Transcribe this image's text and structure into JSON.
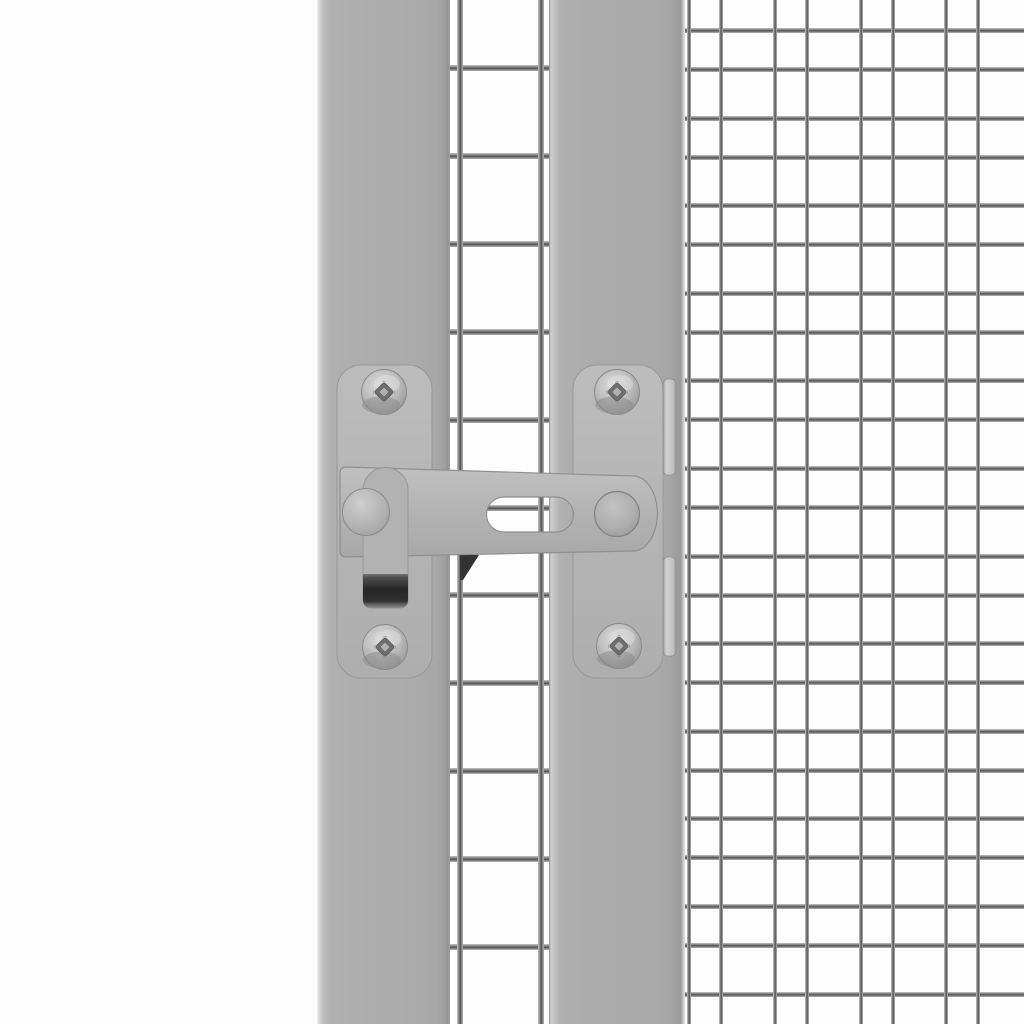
{
  "meta": {
    "description": "Close-up product photo of a grey metal gate latch mounted across two grey square posts of a wire-mesh aviary cage panel, white background",
    "width": 1024,
    "height": 1024
  },
  "colors": {
    "background": "#fdfdfd",
    "post": "#ababab",
    "plate": "#b6b6b6",
    "plate_outline": "#8f8f8f",
    "arm": "#b4b4b4",
    "arm_outline": "#8f8f8f",
    "handle": "#b2b2b2",
    "handle_tab_dark": "#262626",
    "wire_light": "#c4c4c4",
    "wire_dark": "#525252",
    "wedge": "#333333",
    "screw_socket": "#6e6e6e",
    "clip_tab": "#cccccc"
  },
  "layout": {
    "left_post": {
      "x": 317,
      "w": 133
    },
    "gap": {
      "x": 450,
      "w": 99
    },
    "mid_post": {
      "x": 549,
      "w": 136
    },
    "right_mesh": {
      "x": 685,
      "w": 339
    }
  },
  "gap_mesh": {
    "vertical_wires_x": [
      457,
      538
    ],
    "vertical_wire_width": 6,
    "horizontal_first_y": 65,
    "horizontal_spacing": 87.9,
    "horizontal_count": 11,
    "horizontal_wire_height": 6
  },
  "right_mesh": {
    "horizontal_first_y": 28,
    "horizontal_pair_offset": 39,
    "horizontal_spacing": 87.6,
    "horizontal_pairs": 12,
    "horizontal_wire_height": 5,
    "vertical_first_x": 687,
    "vertical_pair_offset": 32,
    "vertical_spacing": 85.8,
    "vertical_pairs": 4,
    "vertical_wire_width": 4
  },
  "latch": {
    "parts": [
      "mounting-plate-left",
      "mounting-plate-right",
      "screw-top-left",
      "screw-top-right",
      "screw-bottom-left",
      "screw-bottom-right",
      "latch-arm",
      "latch-arm-slot",
      "latch-handle",
      "handle-grip-tab",
      "pivot-cap",
      "catch-pin",
      "clip-tab-top",
      "clip-tab-bottom",
      "catch-wedge"
    ],
    "screw_centers": [
      [
        384,
        392
      ],
      [
        617,
        392
      ],
      [
        385,
        647
      ],
      [
        619,
        646
      ]
    ],
    "screw_radius": 22.5
  }
}
